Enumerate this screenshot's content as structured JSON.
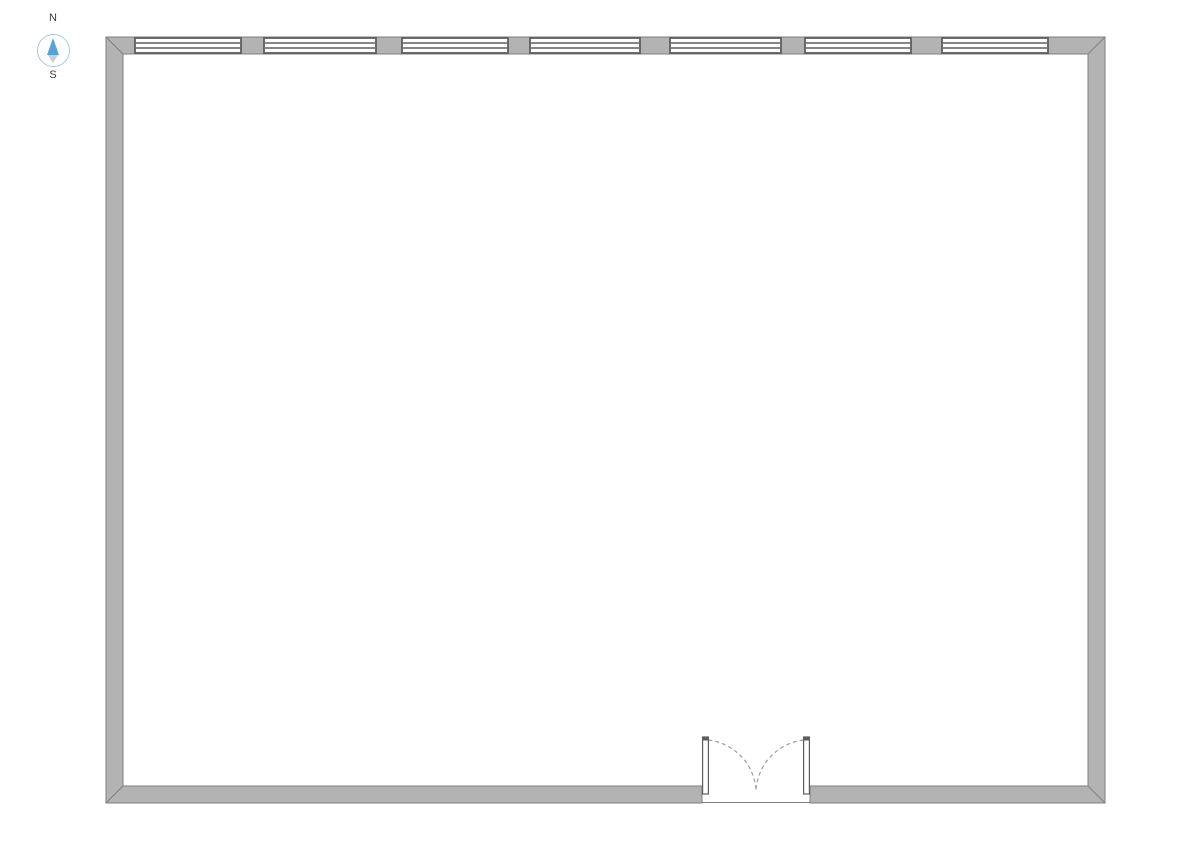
{
  "compass": {
    "north_label": "N",
    "south_label": "S",
    "ring_color": "#abc8de",
    "north_needle_color": "#58a2d5",
    "south_needle_color": "#c9cdd0",
    "label_color": "#3d3d3d"
  },
  "floorplan": {
    "colors": {
      "background": "#ffffff",
      "wall_fill": "#b3b3b3",
      "wall_stroke": "#7f7f7f",
      "feature_stroke": "#5e5e5e",
      "window_fill": "#ffffff",
      "door_leaf_fill": "#ffffff",
      "swing_arc": "#a0a0a0"
    },
    "outer_rect": {
      "x": 106,
      "y": 37,
      "width": 999,
      "height": 766
    },
    "wall_thickness": 17,
    "north_wall_windows": [
      {
        "id": "window-1",
        "x": 135,
        "width": 106
      },
      {
        "id": "window-2",
        "x": 264,
        "width": 112
      },
      {
        "id": "window-3",
        "x": 402,
        "width": 106
      },
      {
        "id": "window-4",
        "x": 530,
        "width": 110
      },
      {
        "id": "window-5",
        "x": 670,
        "width": 111
      },
      {
        "id": "window-6",
        "x": 805,
        "width": 106
      },
      {
        "id": "window-7",
        "x": 942,
        "width": 106
      }
    ],
    "door": {
      "id": "entrance-double-door",
      "type": "double-leaf-inswing",
      "wall": "south",
      "opening_x": 702,
      "opening_width": 108,
      "leaf_thickness": 5.8,
      "leaf_length": 57,
      "swing_radius": 54
    }
  }
}
